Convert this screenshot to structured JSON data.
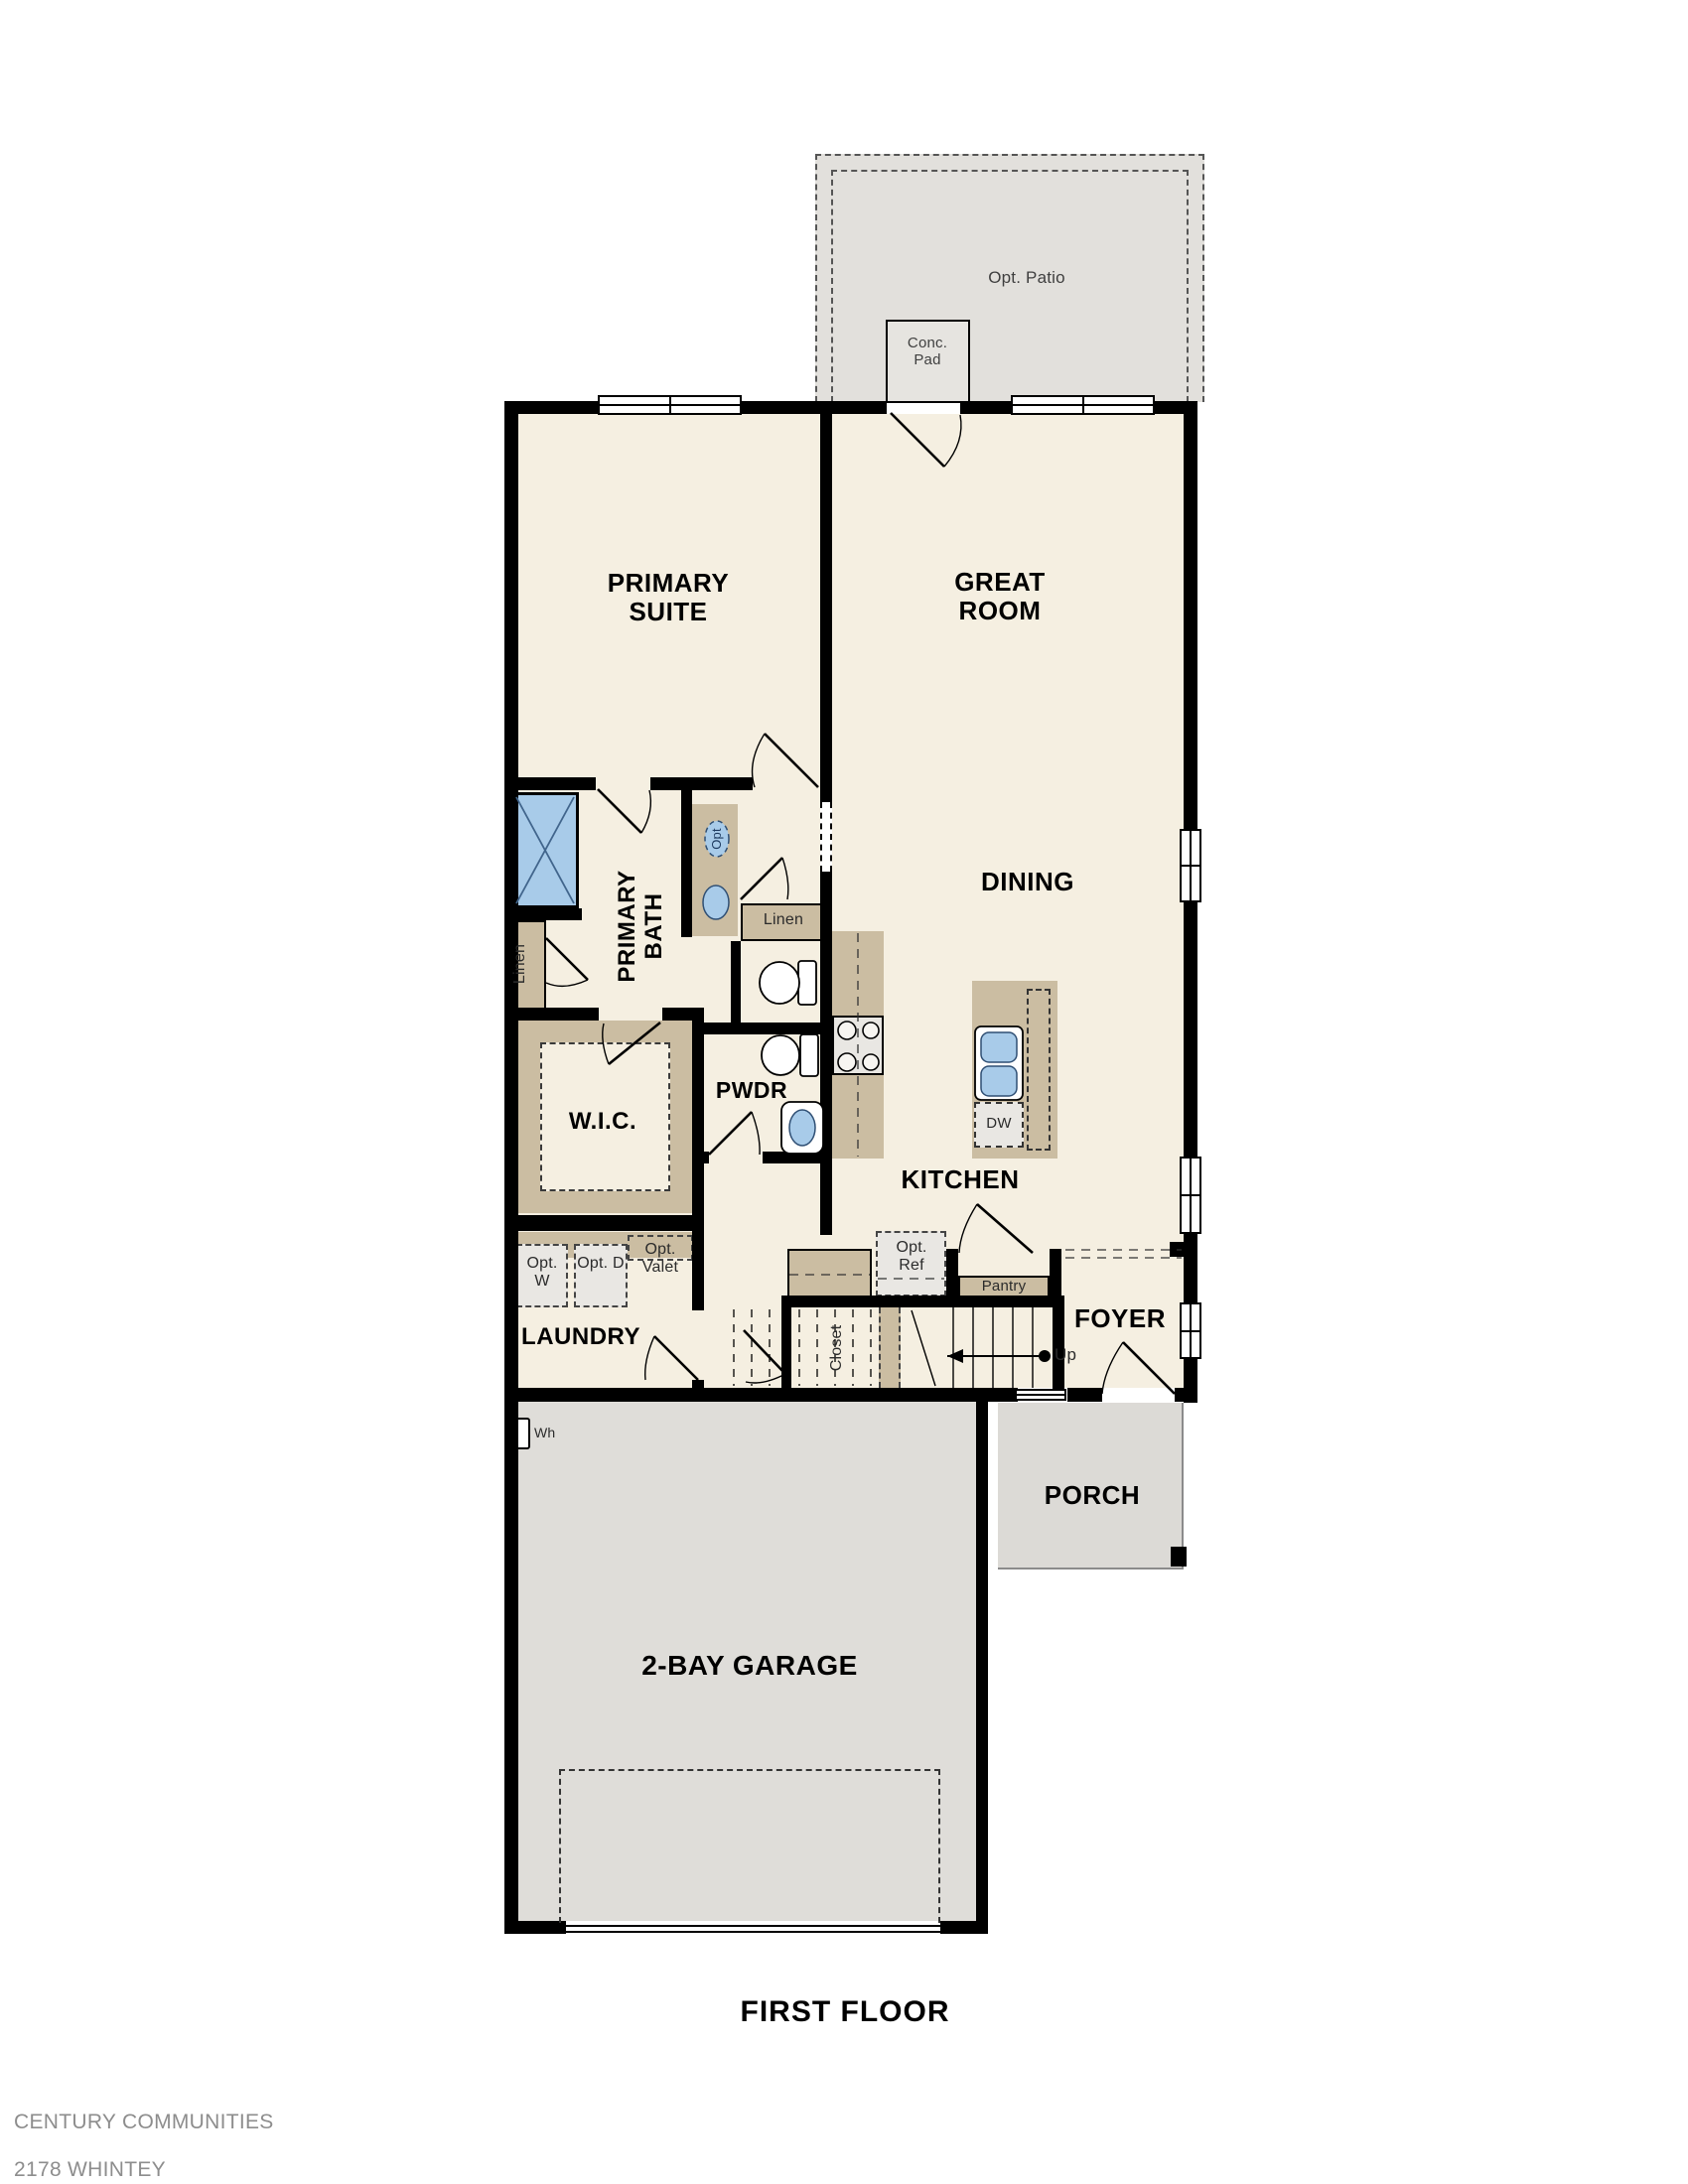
{
  "plan": {
    "title": "FIRST FLOOR",
    "footer": {
      "company": "CENTURY COMMUNITIES",
      "model": "2178 WHINTEY",
      "revision": "REV 01.14.2021"
    }
  },
  "labels": {
    "primary_suite": "PRIMARY SUITE",
    "great_room": "GREAT ROOM",
    "dining": "DINING",
    "kitchen": "KITCHEN",
    "primary_bath": "PRIMARY BATH",
    "wic": "W.I.C.",
    "pwdr": "PWDR",
    "laundry": "LAUNDRY",
    "foyer": "FOYER",
    "porch": "PORCH",
    "garage": "2-BAY GARAGE",
    "closet": "Closet",
    "pantry": "Pantry",
    "linen_right": "Linen",
    "linen_left": "Linen",
    "up": "Up",
    "dw": "DW",
    "wh": "Wh",
    "opt_patio": "Opt. Patio",
    "conc_pad": "Conc. Pad",
    "opt_ref": "Opt. Ref",
    "opt_w": "Opt. W",
    "opt_d": "Opt. D",
    "opt_valet": "Opt. Valet",
    "opt_sink": "Opt"
  },
  "colors": {
    "wall": "#000000",
    "floor": "#f5efe1",
    "patio": "#e2e0dc",
    "garage": "#dfddd9",
    "porch": "#dcdad6",
    "cabinet": "#cbbda2",
    "fixture_blue": "#a8cbe9",
    "footer_text": "#8d8d8d"
  }
}
